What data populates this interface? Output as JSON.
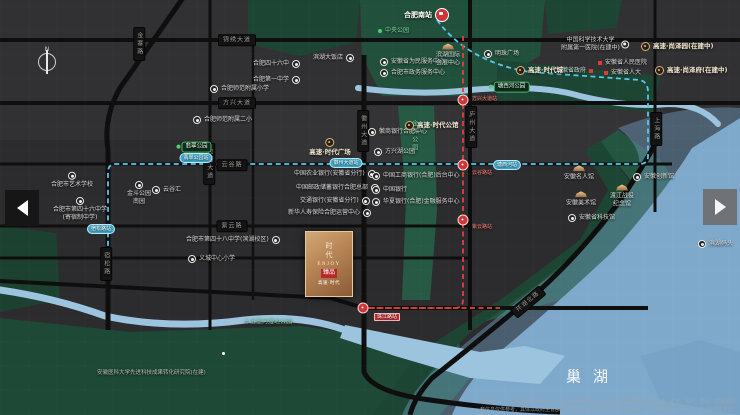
{
  "map": {
    "lake_name": "巢湖",
    "station_main": "合肥南站",
    "logo": {
      "vertical": "时代",
      "latin": "ENJOY",
      "seal": "臻品",
      "caption": "高速·时代"
    },
    "disclaimer": "温馨提示：本宣传资料为要约邀请，不作为要约或承诺；图中距离数据源自地图软件，教育、医疗、商业、交通等配套信息仅供参考，具体以政府主管部门批准文件及买卖双方合同约定为准。本资料制作时间为2021年，敬请留意最新资料。",
    "colors": {
      "water": "#7fa9cb",
      "park": "#1d4534",
      "road": "#0e0e0e",
      "metro_blue": "#55c8ea",
      "metro_red": "#e04040",
      "bronze": "#b98757"
    },
    "labels": [
      {
        "type": "plate-h",
        "t": "锦绣大道",
        "x": 237,
        "y": 40
      },
      {
        "type": "plate-h",
        "t": "方兴大道",
        "x": 237,
        "y": 103
      },
      {
        "type": "plate-h",
        "t": "云谷路",
        "x": 232,
        "y": 165
      },
      {
        "type": "plate-h",
        "t": "紫云路",
        "x": 232,
        "y": 226
      },
      {
        "type": "plate-v",
        "t": "金寨路",
        "x": 139,
        "y": 44
      },
      {
        "type": "plate-v",
        "t": "包河大道",
        "x": 209,
        "y": 164
      },
      {
        "type": "plate-v",
        "t": "宿松路",
        "x": 106,
        "y": 264
      },
      {
        "type": "plate-v",
        "t": "徽州大道",
        "x": 363,
        "y": 131
      },
      {
        "type": "plate-v",
        "t": "庐州大道",
        "x": 471,
        "y": 127
      },
      {
        "type": "plate-v",
        "t": "上海路",
        "x": 656,
        "y": 129
      },
      {
        "type": "plate-r",
        "t": "环湖北路",
        "x": 509,
        "y": 296,
        "rot": -40
      },
      {
        "type": "hsr",
        "t": "合肥南站",
        "x": 404,
        "y": 8
      },
      {
        "type": "spill",
        "t": "宿松路站",
        "x": 101,
        "y": 229
      },
      {
        "type": "spill",
        "t": "翡翠公园站",
        "x": 196,
        "y": 158
      },
      {
        "type": "spill",
        "t": "徽州大道站",
        "x": 346,
        "y": 163
      },
      {
        "type": "spill",
        "t": "塘西河站",
        "x": 507,
        "y": 165
      },
      {
        "type": "rpill",
        "x": 463,
        "y": 100
      },
      {
        "type": "rpill",
        "x": 463,
        "y": 165
      },
      {
        "type": "rpill",
        "x": 463,
        "y": 220
      },
      {
        "type": "rpill",
        "x": 363,
        "y": 308
      },
      {
        "type": "rtxt",
        "t": "方兴大道站",
        "x": 472,
        "y": 96
      },
      {
        "type": "rtxt",
        "t": "云谷路站",
        "x": 472,
        "y": 170
      },
      {
        "type": "rtxt",
        "t": "紫云路站",
        "x": 472,
        "y": 224
      },
      {
        "type": "rtag",
        "t": "珠江路站",
        "x": 374,
        "y": 313
      },
      {
        "type": "gbadge",
        "t": "翡翠公园",
        "x": 194,
        "y": 147
      },
      {
        "type": "gbadge",
        "t": "塘西河公园",
        "x": 509,
        "y": 87
      },
      {
        "type": "gdott",
        "t": "中央公园",
        "x": 378,
        "y": 27
      },
      {
        "type": "gtxt",
        "t": "十五里河湿地公园",
        "x": 268,
        "y": 322
      },
      {
        "type": "gtxt-v",
        "t": "金斗公园",
        "x": 414,
        "y": 136
      },
      {
        "type": "poi-r",
        "t": "合肥四十六中",
        "x": 253,
        "y": 60
      },
      {
        "type": "poi-r",
        "t": "合肥第一中学",
        "x": 253,
        "y": 76
      },
      {
        "type": "poi-r",
        "t": "滨湖大饭店",
        "x": 313,
        "y": 54
      },
      {
        "type": "poi-l",
        "t": "合肥师范附属小学",
        "x": 210,
        "y": 85
      },
      {
        "type": "poi-l",
        "t": "合肥师范附属二小",
        "x": 193,
        "y": 116
      },
      {
        "type": "poi2",
        "lines": [
          "合肥市艺术学校"
        ],
        "x": 72,
        "y": 180
      },
      {
        "type": "poi2",
        "lines": [
          "合肥市第四十六中学",
          "(寄宿制中学)"
        ],
        "x": 80,
        "y": 209
      },
      {
        "type": "poi2",
        "lines": [
          "金斗公园",
          "南园"
        ],
        "x": 139,
        "y": 193
      },
      {
        "type": "poi-l",
        "t": "云谷汇",
        "x": 152,
        "y": 186
      },
      {
        "type": "poi-r",
        "t": "合肥市第四十八中学(滨湖校区)",
        "x": 186,
        "y": 236
      },
      {
        "type": "poi-l",
        "t": "义城中心小学",
        "x": 188,
        "y": 255
      },
      {
        "type": "poi-r",
        "t": "中国农业银行(安徽省分行)",
        "x": 294,
        "y": 170
      },
      {
        "type": "poi-r",
        "t": "中国邮政储蓄银行合肥总部",
        "x": 296,
        "y": 184
      },
      {
        "type": "poi-r",
        "t": "交通银行(安徽省分行)",
        "x": 300,
        "y": 197
      },
      {
        "type": "poi-r",
        "t": "新华人寿保险合肥运营中心",
        "x": 288,
        "y": 209
      },
      {
        "type": "poi-l",
        "t": "中国工商银行(合肥)后台中心",
        "x": 372,
        "y": 172
      },
      {
        "type": "poi-l",
        "t": "中国银行",
        "x": 372,
        "y": 186
      },
      {
        "type": "poi-l",
        "t": "华夏银行(合肥)金融服务中心",
        "x": 372,
        "y": 198
      },
      {
        "type": "poi-l",
        "t": "安徽省为民服务中心",
        "x": 380,
        "y": 58
      },
      {
        "type": "poi-l",
        "t": "合肥市政务服务中心",
        "x": 380,
        "y": 69
      },
      {
        "type": "poi-l",
        "t": "明珠广场",
        "x": 484,
        "y": 50
      },
      {
        "type": "poi-l",
        "t": "徽商银行合肥中心",
        "x": 368,
        "y": 128
      },
      {
        "type": "poi-l",
        "t": "方兴湖公园",
        "x": 374,
        "y": 148
      },
      {
        "type": "poi2r",
        "lines": [
          "中国科学技术大学",
          "附属第一医院(在建中)"
        ],
        "x": 595,
        "y": 44
      },
      {
        "type": "sq-r",
        "t": "安徽省政府",
        "x": 556,
        "y": 67
      },
      {
        "type": "sq-l",
        "t": "安徽省人民医院",
        "x": 598,
        "y": 59
      },
      {
        "type": "sq-l",
        "t": "安徽省人大",
        "x": 604,
        "y": 69
      },
      {
        "type": "brand-top",
        "t": "高速·时代广场",
        "x": 330,
        "y": 147
      },
      {
        "type": "brand",
        "t": "高速·时代公馆",
        "x": 405,
        "y": 121
      },
      {
        "type": "brand",
        "t": "高速·时代城",
        "x": 516,
        "y": 66
      },
      {
        "type": "brand",
        "t": "高速·尚泽园(在建中)",
        "x": 641,
        "y": 42
      },
      {
        "type": "brand",
        "t": "高速·尚泽府(在建中)",
        "x": 655,
        "y": 66
      },
      {
        "type": "gold",
        "lines": [
          "滨湖国际",
          "会展中心"
        ],
        "x": 448,
        "y": 55
      },
      {
        "type": "gold",
        "lines": [
          "安徽名人馆"
        ],
        "x": 579,
        "y": 173
      },
      {
        "type": "poi-l",
        "t": "安徽创新馆",
        "x": 633,
        "y": 173
      },
      {
        "type": "gold",
        "lines": [
          "安徽美术馆"
        ],
        "x": 581,
        "y": 199
      },
      {
        "type": "gold",
        "lines": [
          "渡江战役",
          "纪念馆"
        ],
        "x": 622,
        "y": 196
      },
      {
        "type": "poi-l",
        "t": "安徽省科技馆",
        "x": 568,
        "y": 214
      },
      {
        "type": "poi-l",
        "t": "滨湖码头",
        "x": 698,
        "y": 240
      },
      {
        "type": "dot",
        "x": 222,
        "y": 352
      },
      {
        "type": "plain",
        "t": "安徽医科大学先进科技成果转化研究院(在建)",
        "x": 97,
        "y": 370
      },
      {
        "type": "lake",
        "t": "巢湖",
        "x": 593,
        "y": 377
      },
      {
        "type": "disc",
        "t": "",
        "x": 480,
        "y": 399
      }
    ]
  },
  "nav": {
    "left": "previous-view",
    "right": "next-view"
  }
}
